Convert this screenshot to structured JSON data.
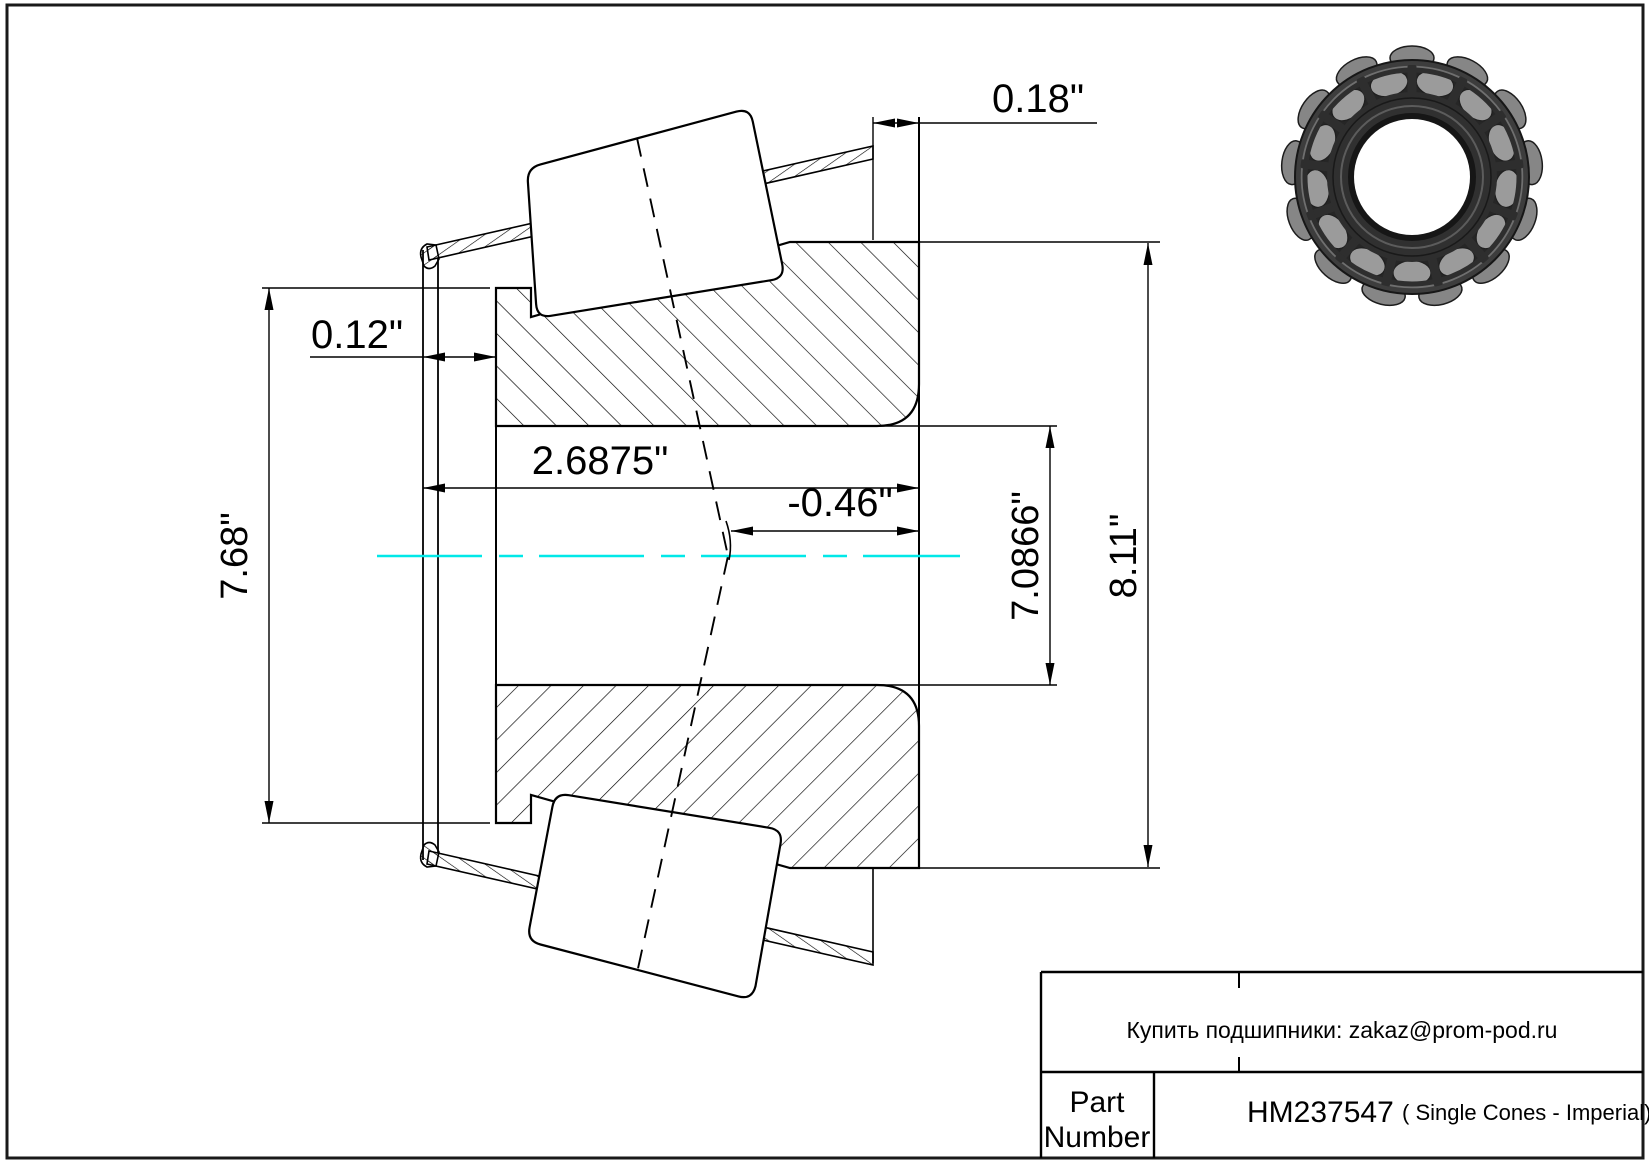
{
  "drawing": {
    "dimensions": {
      "cage_standout_front": "0.18\"",
      "cage_standout_back": "0.12\"",
      "cone_width": "2.6875\"",
      "effective_load_center": "-0.46\"",
      "cone_bore": "7.0866\"",
      "front_od": "8.11\"",
      "back_od": "7.68\""
    },
    "centerline_color": "#00e8e8",
    "line_color": "#000000"
  },
  "title_block": {
    "contact_line": "Купить подшипники: zakaz@prom-pod.ru",
    "part_label_line1": "Part",
    "part_label_line2": "Number",
    "part_number": "HM237547",
    "part_series": "( Single Cones - Imperial)"
  }
}
